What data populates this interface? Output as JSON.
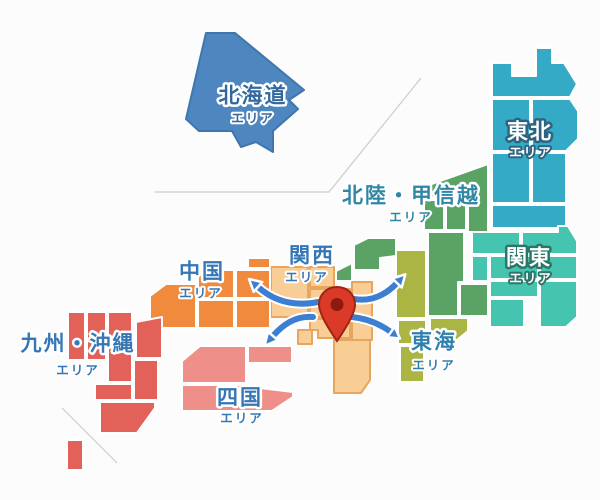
{
  "map": {
    "country": "日本",
    "dividers": {
      "color": "#cccccc"
    }
  },
  "regions": {
    "hokkaido": {
      "name": "北海道",
      "area_suffix": "エリア",
      "fill": "#4e86bf",
      "label_color": "#33689f",
      "label_outline": "#ffffff"
    },
    "tohoku": {
      "name": "東北",
      "area_suffix": "エリア",
      "fill": "#34aac6",
      "label_color": "#ffffff",
      "label_outline": "#2c6480"
    },
    "hokuriku_koshinetsu": {
      "name": "北陸・甲信越",
      "area_suffix": "エリア",
      "fill": "#5aa365",
      "label_color": "#2f87a5",
      "label_outline": "#ffffff"
    },
    "kanto": {
      "name": "関東",
      "area_suffix": "エリア",
      "fill": "#45c4b0",
      "label_color": "#ffffff",
      "label_outline": "#2d7568"
    },
    "kansai": {
      "name": "関西",
      "area_suffix": "エリア",
      "fill": "#f8cd96",
      "border": "#e7a55e",
      "label_color": "#3577b5",
      "label_outline": "#ffffff"
    },
    "tokai": {
      "name": "東海",
      "area_suffix": "エリア",
      "fill": "#abb544",
      "label_color": "#3080ad",
      "label_outline": "#ffffff"
    },
    "chugoku": {
      "name": "中国",
      "area_suffix": "エリア",
      "fill": "#f08a3d",
      "label_color": "#3577b5",
      "label_outline": "#ffffff"
    },
    "shikoku": {
      "name": "四国",
      "area_suffix": "エリア",
      "fill": "#ee9089",
      "label_color": "#3577b5",
      "label_outline": "#ffffff"
    },
    "kyushu_okinawa": {
      "name": "九州・沖縄",
      "area_suffix": "エリア",
      "fill": "#e2625a",
      "label_color": "#3577b5",
      "label_outline": "#ffffff"
    }
  },
  "marker": {
    "type": "location-pin",
    "fill": "#dc3a28",
    "stroke": "#9e2415",
    "dot": "#8c1a0e"
  },
  "arrows": {
    "color": "#3b7ed2",
    "outline": "#ffffff",
    "directions": [
      "up-left",
      "up-right",
      "down-left",
      "down-right"
    ]
  }
}
